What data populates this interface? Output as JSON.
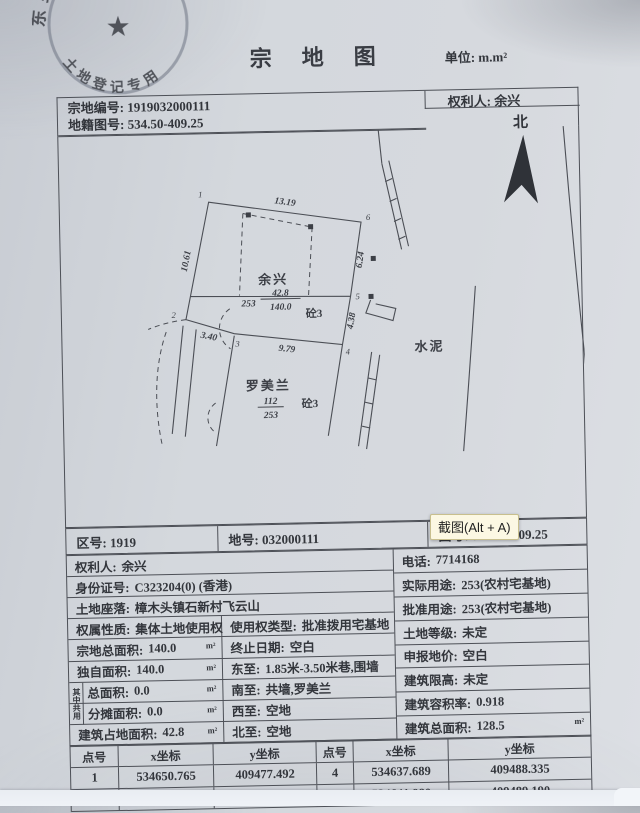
{
  "title": "宗地图",
  "unit": {
    "label": "单位:",
    "value": "m.m²"
  },
  "stamp": {
    "arc_top": "东莞市",
    "arc_bottom": "土地登记专用",
    "star": "★"
  },
  "header": {
    "parcel_no_label": "宗地编号:",
    "parcel_no": "1919032000111",
    "map_sheet_label": "地籍图号:",
    "map_sheet_no": "534.50-409.25",
    "holder_label": "权利人:",
    "holder_name": "余兴"
  },
  "compass": {
    "north_label": "北"
  },
  "map": {
    "dims": {
      "top": "13.19",
      "left": "10.61",
      "right_upper": "6.24",
      "right_lower": "4.38",
      "bottom": "9.79",
      "bottom_left": "3.40"
    },
    "points": {
      "p1": "1",
      "p2": "2",
      "p3": "3",
      "p4": "4",
      "p5": "5",
      "p6": "6"
    },
    "owner": {
      "name": "余兴",
      "code": "253",
      "area_building": "42.8",
      "area_total": "140.0",
      "structure": "砼3"
    },
    "neighbor": {
      "name": "罗美兰",
      "num": "112",
      "den": "253",
      "structure": "砼3"
    },
    "cement_label": "水泥"
  },
  "screenshot_tooltip": {
    "label": "截图(Alt + A)"
  },
  "district_row": {
    "zone_label": "区号:",
    "zone": "1919",
    "lot_label": "地号:",
    "lot": "032000111",
    "map_no_label": "图号:",
    "map_no": "534.50-409.25"
  },
  "shared_group_label": "其中共用",
  "info_left": [
    {
      "label": "权利人:",
      "value": "余兴"
    },
    {
      "label": "身份证号:",
      "value": "C323204(0) (香港)"
    },
    {
      "label": "土地座落:",
      "value": "樟木头镇石新村飞云山"
    },
    {
      "label": "权属性质:",
      "value": "集体土地使用权",
      "mid_label": "使用权类型:",
      "mid_value": "批准拨用宅基地"
    },
    {
      "label": "宗地总面积:",
      "value": "140.0",
      "unit": "m²",
      "mid_label": "终止日期:",
      "mid_value": "空白"
    },
    {
      "label": "独自面积:",
      "value": "140.0",
      "unit": "m²",
      "mid_label": "东至:",
      "mid_value": "1.85米-3.50米巷,围墙"
    },
    {
      "label": "总面积:",
      "value": "0.0",
      "unit": "m²",
      "mid_label": "南至:",
      "mid_value": "共墙,罗美兰"
    },
    {
      "label": "分摊面积:",
      "value": "0.0",
      "unit": "m²",
      "mid_label": "西至:",
      "mid_value": "空地"
    },
    {
      "label": "建筑占地面积:",
      "value": "42.8",
      "unit": "m²",
      "mid_label": "北至:",
      "mid_value": "空地"
    }
  ],
  "info_right": [
    {
      "label": "电话:",
      "value": "7714168"
    },
    {
      "label": "实际用途:",
      "value": "253(农村宅基地)"
    },
    {
      "label": "批准用途:",
      "value": "253(农村宅基地)"
    },
    {
      "label": "土地等级:",
      "value": "未定"
    },
    {
      "label": "申报地价:",
      "value": "空白"
    },
    {
      "label": "建筑限高:",
      "value": "未定"
    },
    {
      "label": "建筑容积率:",
      "value": "0.918"
    },
    {
      "label": "建筑总面积:",
      "value": "128.5",
      "unit": "m²"
    }
  ],
  "coords": {
    "headers": [
      "点号",
      "x坐标",
      "y坐标",
      "点号",
      "x坐标",
      "y坐标"
    ],
    "rows": [
      {
        "pn_a": "1",
        "x_a": "534650.765",
        "y_a": "409477.492",
        "pn_b": "4",
        "x_b": "534637.689",
        "y_b": "409488.335"
      },
      {
        "pn_a": "",
        "x_a": "",
        "y_a": "409476.417",
        "pn_b": "5",
        "x_b": "534641.980",
        "y_b": "409489.190"
      }
    ]
  }
}
